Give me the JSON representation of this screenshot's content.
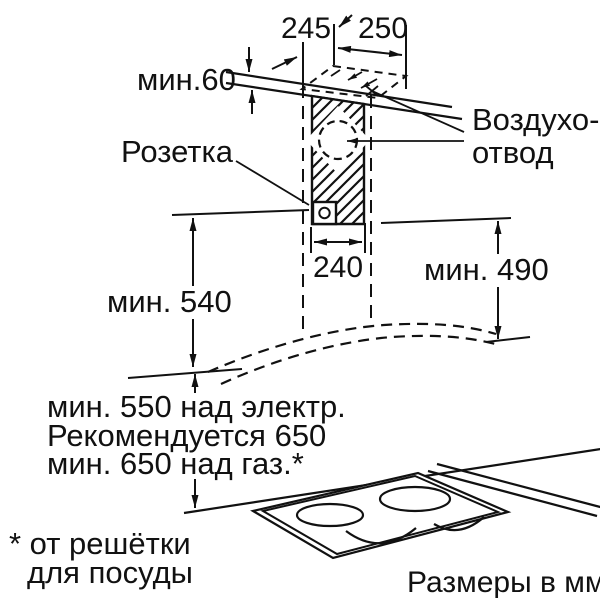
{
  "diagram": {
    "type": "installation-dimension-drawing",
    "units_note": "Размеры в мм",
    "dimensions": {
      "top_depth": "245",
      "top_width": "250",
      "ceiling_clearance": "мин.60",
      "duct_width": "240",
      "right_height": "мин. 490",
      "left_height": "мин. 540",
      "clearance_line1": "мин. 550 над электр.",
      "clearance_line2": "Рекомендуется 650",
      "clearance_line3": "мин. 650 над газ.*"
    },
    "labels": {
      "socket": "Розетка",
      "air_outlet_line1": "Воздухо-",
      "air_outlet_line2": "отвод"
    },
    "footnote_line1": "* от решётки",
    "footnote_line2": "для посуды",
    "colors": {
      "line": "#111111",
      "background": "#ffffff"
    }
  }
}
